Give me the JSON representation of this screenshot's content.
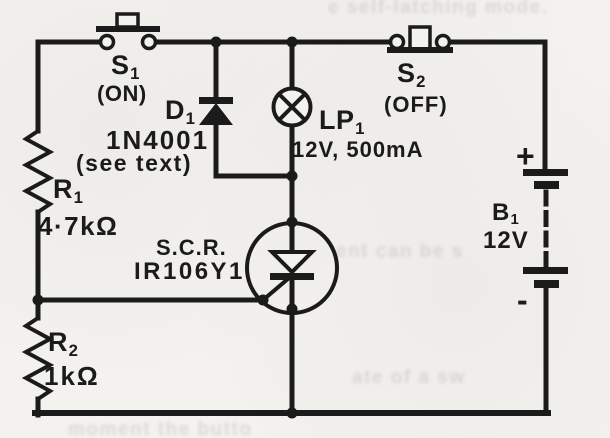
{
  "figure": {
    "kind": "circuit-schematic"
  },
  "colors": {
    "ink": "#1b1b1b",
    "paper": "#f4f2ee"
  },
  "components": {
    "s1": {
      "ref": "S",
      "sub": "1",
      "mode": "(ON)"
    },
    "s2": {
      "ref": "S",
      "sub": "2",
      "mode": "(OFF)"
    },
    "d1": {
      "ref": "D",
      "sub": "1",
      "part": "1N4001",
      "note": "(see text)"
    },
    "lp1": {
      "ref": "LP",
      "sub": "1",
      "rating": "12V, 500mA"
    },
    "r1": {
      "ref": "R",
      "sub": "1",
      "value": "4·7kΩ"
    },
    "r2": {
      "ref": "R",
      "sub": "2",
      "value": "1kΩ"
    },
    "scr": {
      "label": "S.C.R.",
      "part": "IR106Y1"
    },
    "b1": {
      "ref": "B",
      "sub": "1",
      "voltage": "12V",
      "plus_sign": "+",
      "minus_sign": "-"
    }
  },
  "bleedthrough": {
    "note": "faint show-through print from reverse page (illegible)",
    "lines": [
      {
        "text": "e self-latching mode."
      },
      {
        "text": "ent can be s"
      },
      {
        "text": "ate of a sw"
      },
      {
        "text": "moment the butto"
      }
    ]
  }
}
